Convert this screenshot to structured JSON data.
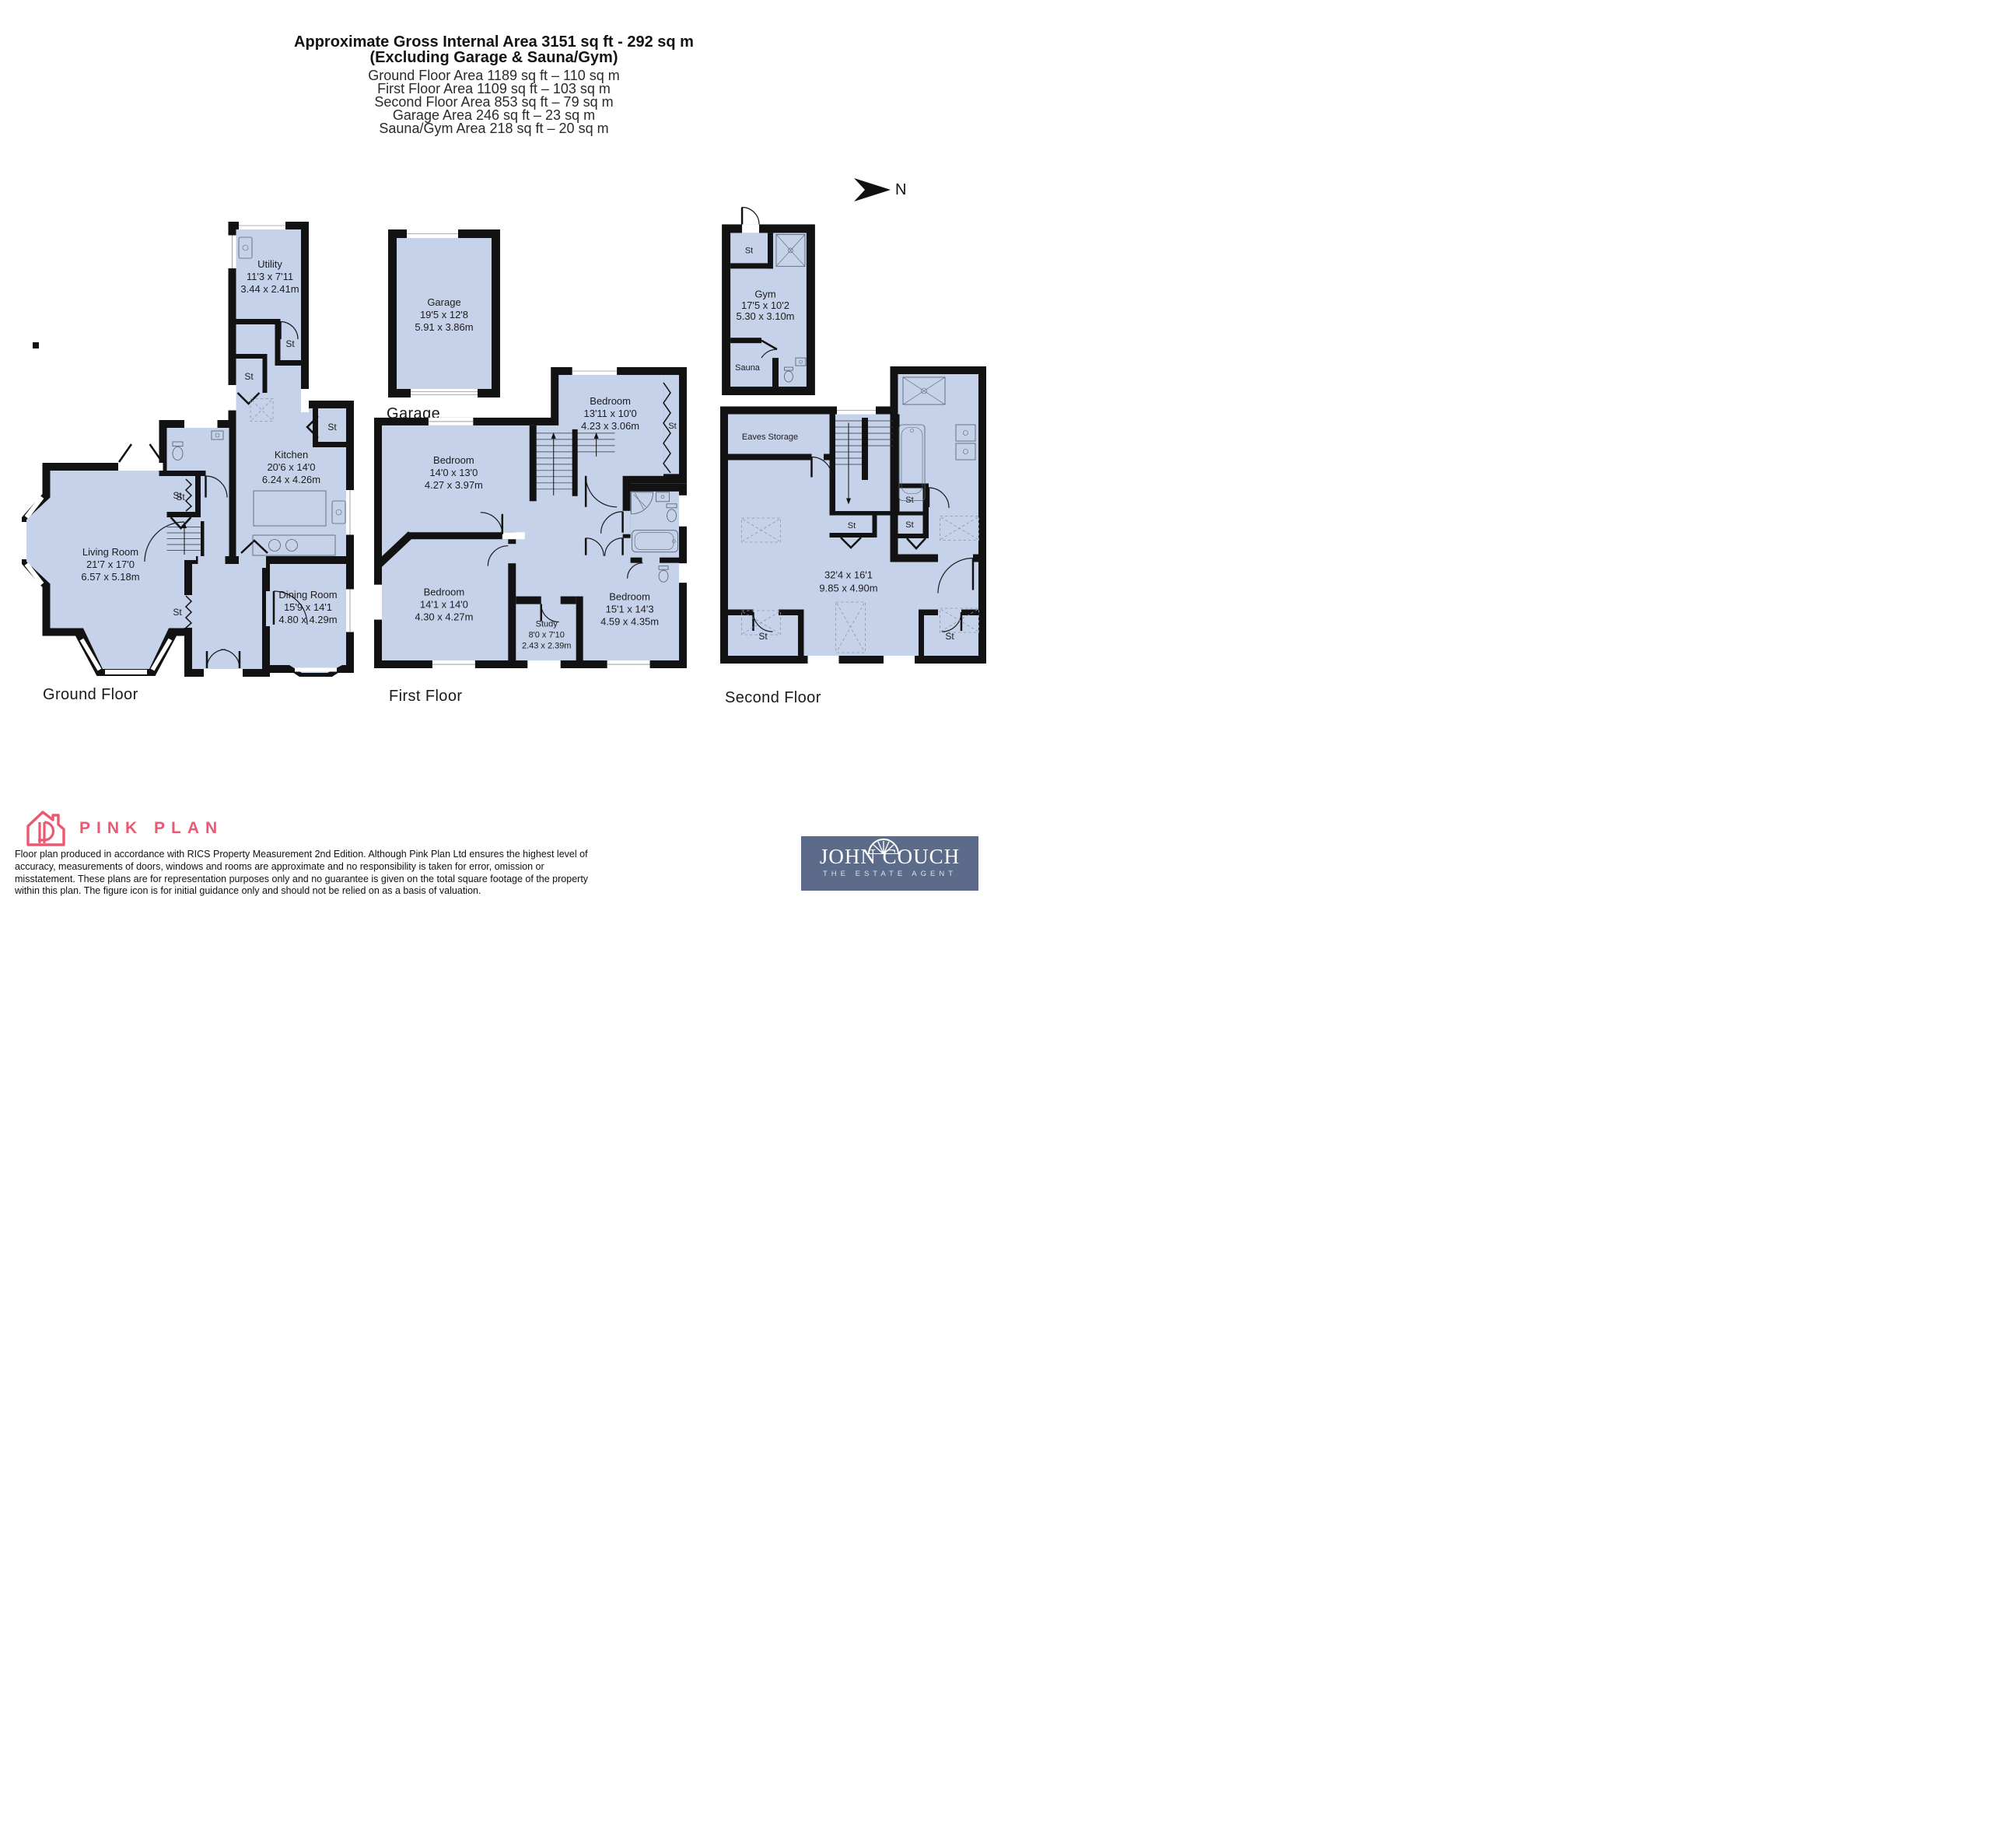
{
  "header": {
    "title1": "Approximate Gross Internal Area 3151 sq ft - 292 sq m",
    "title2": "(Excluding Garage & Sauna/Gym)",
    "areas": [
      "Ground Floor Area 1189 sq ft – 110 sq m",
      "First Floor Area 1109 sq ft – 103 sq m",
      "Second Floor Area 853 sq ft – 79 sq m",
      "Garage Area 246 sq ft – 23 sq m",
      "Sauna/Gym Area 218 sq ft – 20 sq m"
    ]
  },
  "compass": {
    "north": "N"
  },
  "plans": {
    "ground": {
      "caption": "Ground Floor",
      "st": "St",
      "rooms": {
        "living": {
          "name": "Living Room",
          "ft": "21'7 x 17'0",
          "m": "6.57 x 5.18m"
        },
        "dining": {
          "name": "Dining Room",
          "ft": "15'9 x 14'1",
          "m": "4.80 x 4.29m"
        },
        "kitchen": {
          "name": "Kitchen",
          "ft": "20'6 x 14'0",
          "m": "6.24 x 4.26m"
        },
        "utility": {
          "name": "Utility",
          "ft": "11'3 x 7'11",
          "m": "3.44 x 2.41m"
        }
      }
    },
    "garage": {
      "caption": "Garage",
      "room": {
        "name": "Garage",
        "ft": "19'5 x 12'8",
        "m": "5.91 x 3.86m"
      }
    },
    "first": {
      "caption": "First Floor",
      "st": "St",
      "rooms": {
        "bed1": {
          "name": "Bedroom",
          "ft": "14'0 x 13'0",
          "m": "4.27 x 3.97m"
        },
        "bed2": {
          "name": "Bedroom",
          "ft": "13'11 x 10'0",
          "m": "4.23 x 3.06m"
        },
        "bed3": {
          "name": "Bedroom",
          "ft": "14'1 x 14'0",
          "m": "4.30 x 4.27m"
        },
        "study": {
          "name": "Study",
          "ft": "8'0 x 7'10",
          "m": "2.43 x 2.39m"
        },
        "bed4": {
          "name": "Bedroom",
          "ft": "15'1 x 14'3",
          "m": "4.59 x 4.35m"
        }
      }
    },
    "sauna": {
      "caption": "Sauna/Gym",
      "st": "St",
      "rooms": {
        "gym": {
          "name": "Gym",
          "ft": "17'5 x 10'2",
          "m": "5.30 x 3.10m"
        },
        "sauna": {
          "name": "Sauna"
        }
      }
    },
    "second": {
      "caption": "Second Floor",
      "st": "St",
      "rooms": {
        "eaves": {
          "name": "Eaves Storage"
        },
        "main": {
          "ft": "32'4 x 16'1",
          "m": "9.85 x 4.90m"
        }
      }
    }
  },
  "footer": {
    "brand": "PINK PLAN",
    "disclaimer": "Floor plan produced in accordance with RICS Property Measurement 2nd Edition. Although Pink Plan Ltd ensures the highest level of accuracy, measurements of doors, windows and rooms are approximate and no responsibility is taken for error, omission or misstatement. These plans are for representation purposes only and no guarantee is given on the total square footage of the property within this plan. The figure icon is for initial guidance only and should not be relied on as a basis of valuation.",
    "agent": {
      "name": "JOHN COUCH",
      "tagline": "THE ESTATE AGENT"
    }
  },
  "colors": {
    "room_fill": "#c5d2e9",
    "wall": "#121212",
    "brand_pink": "#ec5871",
    "agent_bg": "#5c6b89"
  }
}
